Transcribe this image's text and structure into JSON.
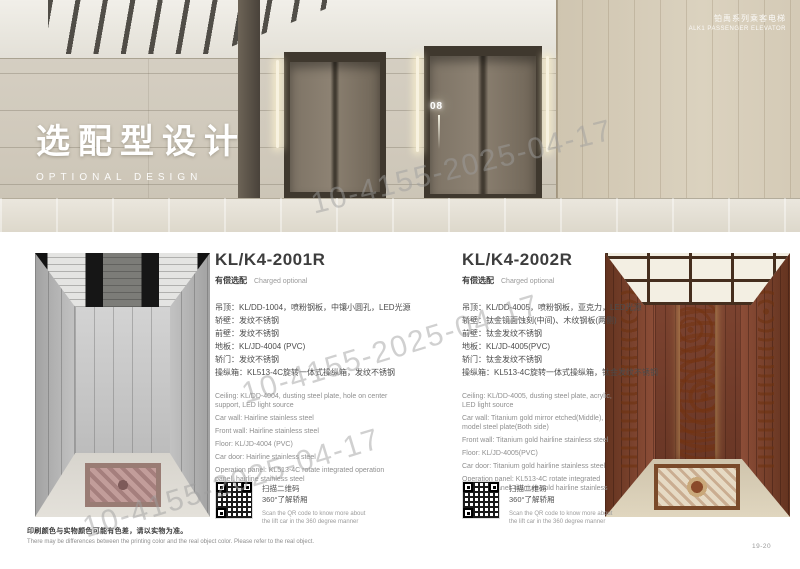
{
  "header": {
    "series_zh": "铂禹系列乘客电梯",
    "series_en": "ALK1 PASSENGER ELEVATOR"
  },
  "hero": {
    "title_zh": "选配型设计",
    "title_en": "OPTIONAL DESIGN",
    "floor_sign": "08"
  },
  "watermark": {
    "text": "10-4155-2025-04-17"
  },
  "products": [
    {
      "model": "KL/K4-2001R",
      "badge_zh": "有偿选配",
      "badge_en": "Charged optional",
      "specs_zh": [
        "吊顶：KL/DD-1004，喷粉钢板，中镶小圆孔，LED光源",
        "轿壁：发纹不锈钢",
        "前壁：发纹不锈钢",
        "地板：KL/JD-4004 (PVC)",
        "轿门：发纹不锈钢",
        "操纵箱：KL513-4C旋转一体式操纵箱，发纹不锈钢"
      ],
      "specs_en": [
        "Ceiling: KL/DD-4004, dusting steel plate, hole on center support, LED light source",
        "Car wall: Hairline stainless steel",
        "Front wall: Hairline stainless steel",
        "Floor: KL/JD-4004 (PVC)",
        "Car door: Hairline stainless steel",
        "Operation panel: KL513-4C rotate integrated operation panel, hairline stainless steel"
      ],
      "qr_zh1": "扫描二维码",
      "qr_zh2": "360°了解轿厢",
      "qr_en": "Scan the QR code to know more about the lift car in the 360 degree manner"
    },
    {
      "model": "KL/K4-2002R",
      "badge_zh": "有偿选配",
      "badge_en": "Charged optional",
      "specs_zh": [
        "吊顶：KL/DD-4005，喷粉钢板，亚克力，LED光源",
        "轿壁：钛金镜面蚀刻(中间)、木纹钢板(两侧)",
        "前壁：钛金发纹不锈钢",
        "地板：KL/JD-4005(PVC)",
        "轿门：钛金发纹不锈钢",
        "操纵箱：KL513-4C旋转一体式操纵箱，钛金发纹不锈钢"
      ],
      "specs_en": [
        "Ceiling: KL/DD-4005, dusting steel plate, acrylic, LED light source",
        "Car wall: Titanium gold mirror etched(Middle), model steel plate(Both side)",
        "Front wall: Titanium gold hairline stainless steel",
        "Floor: KL/JD-4005(PVC)",
        "Car door: Titanium gold hairline stainless steel",
        "Operation panel: KL513-4C rotate integrated operation panel, titanium gold hairline stainless steel"
      ],
      "qr_zh1": "扫描二维码",
      "qr_zh2": "360°了解轿厢",
      "qr_en": "Scan the QR code to know more about the lift car in the 360 degree manner"
    }
  ],
  "footer": {
    "note_zh": "印刷颜色与实物颜色可能有色差，请以实物为准。",
    "note_en": "There may be differences between the printing color and the real object color. Please refer to the real object.",
    "page_number": "19-20"
  },
  "colors": {
    "titanium_gold": "#d4a92a",
    "stainless_steel": "#c6c6c6",
    "rosewood": "#7c4330",
    "lobby_stone": "#d3ccbe"
  }
}
